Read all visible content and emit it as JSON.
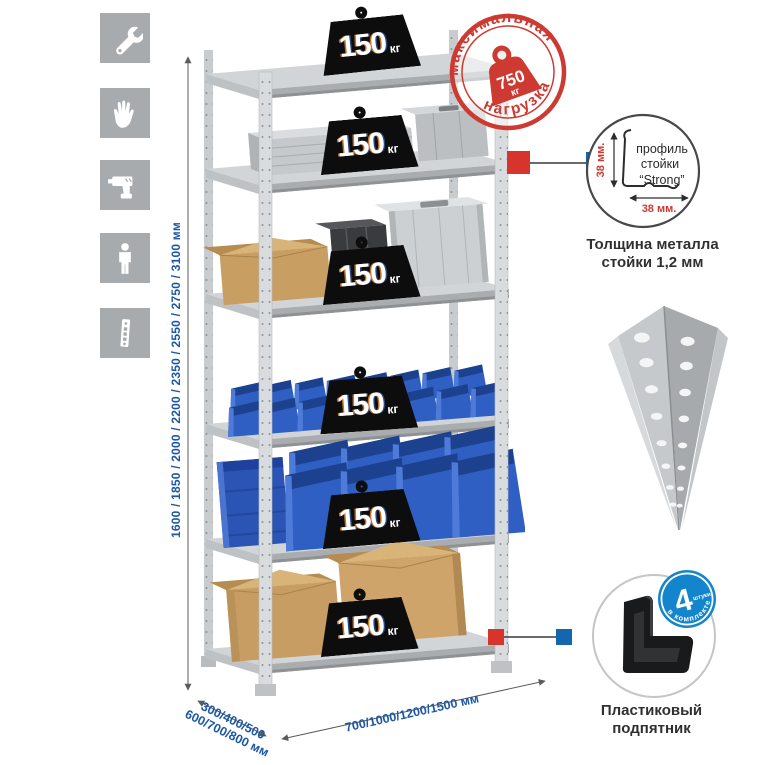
{
  "icons_column": {
    "items": [
      {
        "name": "wrench"
      },
      {
        "name": "gloves"
      },
      {
        "name": "drill"
      },
      {
        "name": "person"
      },
      {
        "name": "perforated-post"
      }
    ]
  },
  "dimensions": {
    "height": "1600 / 1850 / 2000 / 2200 / 2350 / 2550 / 2750 / 3100 мм",
    "depth_line1": "300/400/500",
    "depth_line2": "600/700/800 мм",
    "width": "700/1000/1200/1500 мм"
  },
  "shelf_badges": {
    "unit": "кг",
    "items": [
      {
        "value": "150"
      },
      {
        "value": "150"
      },
      {
        "value": "150"
      },
      {
        "value": "150"
      },
      {
        "value": "150"
      },
      {
        "value": "150"
      }
    ]
  },
  "stamp": {
    "arc_top": "максимальная",
    "arc_bottom": "нагрузка",
    "value": "750",
    "unit": "кг"
  },
  "profile_detail": {
    "label_line1": "профиль",
    "label_line2": "стойки",
    "label_line3": "“Strong”",
    "dim_vertical": "38 мм.",
    "dim_horizontal": "38 мм.",
    "caption_line1": "Толщина металла",
    "caption_line2": "стойки 1,2 мм"
  },
  "foot_detail": {
    "badge_value": "4",
    "badge_note": "штуки",
    "badge_arc": "в комплекте",
    "caption_line1": "Пластиковый",
    "caption_line2": "подпятник"
  },
  "colors": {
    "accent_blue": "#1c57a5",
    "stamp_red": "#cd3a31",
    "badge_blue": "#1385cc",
    "bin_blue": "#2f5fc2",
    "icon_tile_gray": "#a8abad"
  }
}
